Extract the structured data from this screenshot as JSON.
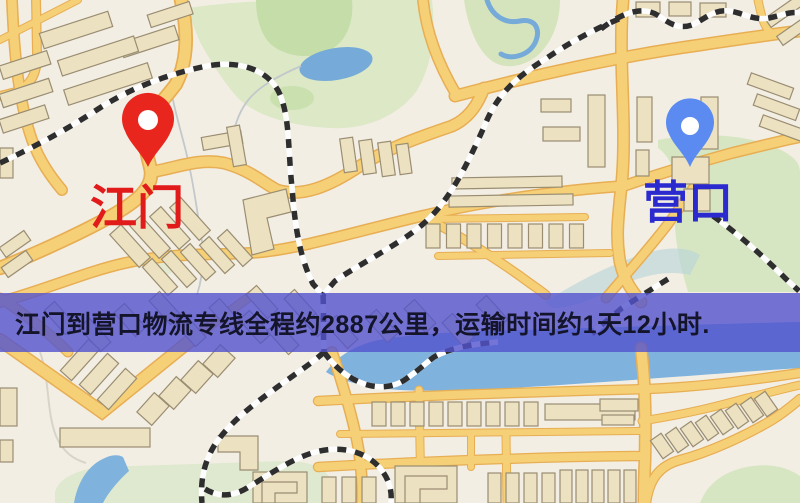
{
  "map": {
    "origin": {
      "label": "江门",
      "pin_color": "#e8261d",
      "label_color": "#e11a1a"
    },
    "destination": {
      "label": "营口",
      "pin_color": "#5b8bf0",
      "label_color": "#2a2ace"
    }
  },
  "banner": {
    "text": "江门到营口物流专线全程约2887公里，运输时间约1天12小时.",
    "background_color": "#5252ce",
    "text_color": "#14142b"
  },
  "theme": {
    "map_background": "#f3eee4",
    "road_fill": "#f6d077",
    "road_casing": "#e7ae54",
    "water": "#7fb2dd",
    "park": "#d9e7c4",
    "park_dark": "#c5dda8",
    "building_fill": "#ece2c2",
    "building_stroke": "#9a8d72",
    "railway_dark": "#2e2e2e",
    "railway_light": "#fdfdfd"
  }
}
